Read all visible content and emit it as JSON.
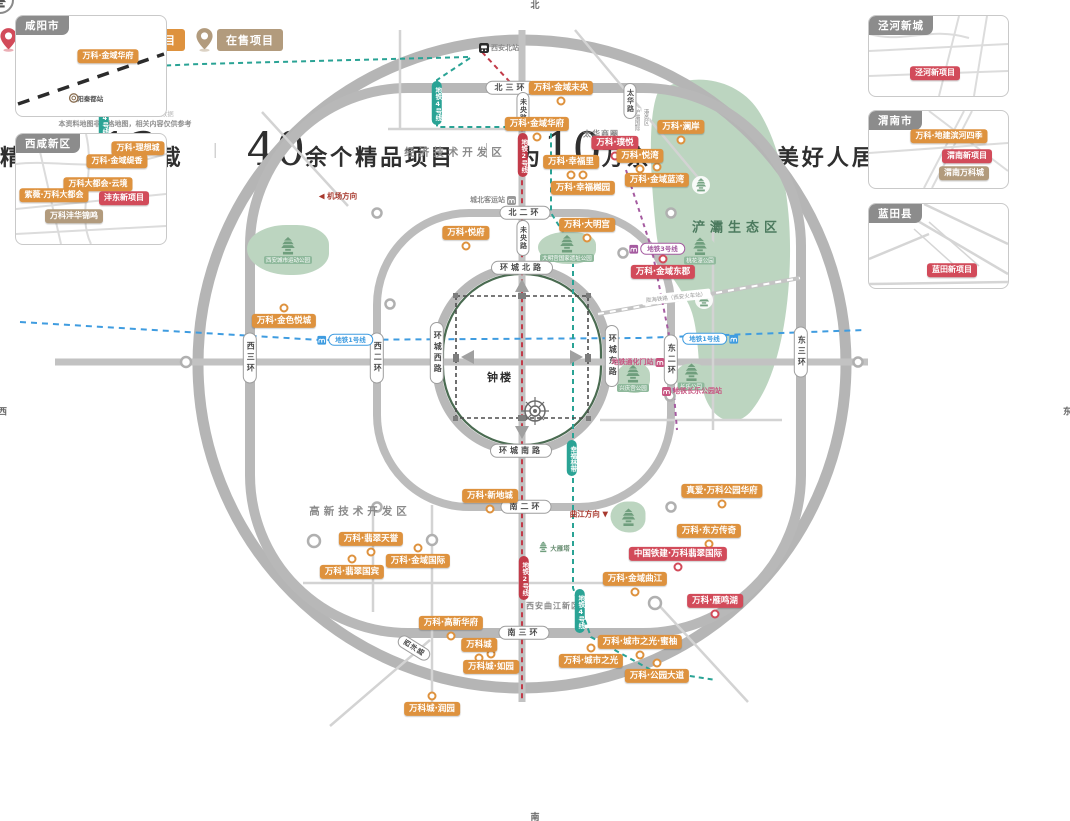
{
  "status_colors": {
    "presale": "#d24b5a",
    "soldout": "#de923e",
    "onsale": "#b29b7d"
  },
  "line_colors": {
    "1": "#3f9ce0",
    "2": "#c23b49",
    "3": "#a55ba0",
    "4": "#2aa395"
  },
  "legend": [
    {
      "label": "待售项目",
      "status": "presale"
    },
    {
      "label": "售罄项目",
      "status": "soldout"
    },
    {
      "label": "在售项目",
      "status": "onsale"
    }
  ],
  "footer": {
    "s1a": "精耕西安",
    "s1n": "13",
    "s1b": "载",
    "s2n": "40",
    "s2b": "余个精品项目",
    "s3a": "为",
    "s3n": "10",
    "s3b": "万余户业主打造美好人居生活",
    "divider": "｜"
  },
  "compass": {
    "n": "北",
    "s": "南",
    "e": "东",
    "w": "西"
  },
  "disclaimer": {
    "line1": "图中地铁信息来源于地铁官方数据",
    "line2": "本资料地图非严格地图，相关内容仅供参考"
  },
  "insets": [
    {
      "title": "咸阳市",
      "labels": [
        {
          "text": "万科·金域华府",
          "status": "soldout",
          "x": 92,
          "y": 40
        }
      ],
      "station": "咸阳秦都站",
      "station_x": 70,
      "station_y": 82
    },
    {
      "title": "西咸新区",
      "labels": [
        {
          "text": "万科·理想城",
          "status": "soldout",
          "x": 122,
          "y": 14
        },
        {
          "text": "万科·金域缇香",
          "status": "soldout",
          "x": 101,
          "y": 27
        },
        {
          "text": "万科大都会·云境",
          "status": "soldout",
          "x": 82,
          "y": 50
        },
        {
          "text": "紫薇·万科大都会",
          "status": "soldout",
          "x": 38,
          "y": 61
        },
        {
          "text": "沣东新项目",
          "status": "presale",
          "x": 108,
          "y": 64
        },
        {
          "text": "万科沣华锦鸣",
          "status": "onsale",
          "x": 58,
          "y": 82
        }
      ]
    },
    {
      "title": "泾河新城",
      "labels": [
        {
          "text": "泾河新项目",
          "status": "presale",
          "x": 66,
          "y": 57
        }
      ]
    },
    {
      "title": "渭南市",
      "labels": [
        {
          "text": "万科·地建滨河四季",
          "status": "soldout",
          "x": 80,
          "y": 25
        },
        {
          "text": "渭南新项目",
          "status": "presale",
          "x": 98,
          "y": 45
        },
        {
          "text": "渭南万科城",
          "status": "onsale",
          "x": 95,
          "y": 62
        }
      ]
    },
    {
      "title": "蓝田县",
      "labels": [
        {
          "text": "蓝田新项目",
          "status": "presale",
          "x": 83,
          "y": 66
        }
      ]
    }
  ],
  "map": {
    "projects": [
      {
        "text": "万科·金域未央",
        "status": "soldout",
        "x": 561,
        "y": 88,
        "pin": "below"
      },
      {
        "text": "万科·金域华府",
        "status": "soldout",
        "x": 537,
        "y": 124,
        "pin": "below"
      },
      {
        "text": "万科·璞悦",
        "status": "presale",
        "x": 615,
        "y": 143,
        "pin": "below"
      },
      {
        "text": "万科·悦湾",
        "status": "soldout",
        "x": 640,
        "y": 156,
        "pin": "below"
      },
      {
        "text": "万科·澜岸",
        "status": "soldout",
        "x": 681,
        "y": 127,
        "pin": "below"
      },
      {
        "text": "万科·幸福里",
        "status": "soldout",
        "x": 571,
        "y": 162,
        "pin": "below"
      },
      {
        "text": "万科·幸福樾园",
        "status": "soldout",
        "x": 583,
        "y": 188,
        "pin": "above"
      },
      {
        "text": "万科·金域蓝湾",
        "status": "soldout",
        "x": 657,
        "y": 180,
        "pin": "above"
      },
      {
        "text": "万科·大明宫",
        "status": "soldout",
        "x": 587,
        "y": 225,
        "pin": "below"
      },
      {
        "text": "万科·悦府",
        "status": "soldout",
        "x": 466,
        "y": 233,
        "pin": "below"
      },
      {
        "text": "万科·金域东郡",
        "status": "presale",
        "x": 663,
        "y": 272,
        "pin": "above"
      },
      {
        "text": "万科·金色悦城",
        "status": "soldout",
        "x": 284,
        "y": 321,
        "pin": "above"
      },
      {
        "text": "万科·新地城",
        "status": "soldout",
        "x": 490,
        "y": 496,
        "pin": "below"
      },
      {
        "text": "万科·翡翠天誉",
        "status": "soldout",
        "x": 371,
        "y": 539,
        "pin": "below"
      },
      {
        "text": "万科·金域国际",
        "status": "soldout",
        "x": 418,
        "y": 561,
        "pin": "above"
      },
      {
        "text": "万科·翡翠国宾",
        "status": "soldout",
        "x": 352,
        "y": 572,
        "pin": "above"
      },
      {
        "text": "万科·高新华府",
        "status": "soldout",
        "x": 451,
        "y": 623,
        "pin": "below"
      },
      {
        "text": "万科城",
        "status": "soldout",
        "x": 479,
        "y": 645,
        "pin": "below"
      },
      {
        "text": "万科城·如园",
        "status": "soldout",
        "x": 491,
        "y": 667,
        "pin": "above"
      },
      {
        "text": "万科城·润园",
        "status": "soldout",
        "x": 432,
        "y": 709,
        "pin": "above"
      },
      {
        "text": "万科·城市之光",
        "status": "soldout",
        "x": 591,
        "y": 661,
        "pin": "above"
      },
      {
        "text": "万科·城市之光·蜜柚",
        "status": "soldout",
        "x": 640,
        "y": 642,
        "pin": "below"
      },
      {
        "text": "万科·公园大道",
        "status": "soldout",
        "x": 657,
        "y": 676,
        "pin": "above"
      },
      {
        "text": "真爱·万科公园华府",
        "status": "soldout",
        "x": 722,
        "y": 491,
        "pin": "below"
      },
      {
        "text": "万科·东方传奇",
        "status": "soldout",
        "x": 709,
        "y": 531,
        "pin": "below"
      },
      {
        "text": "中国铁建·万科翡翠国际",
        "status": "presale",
        "x": 678,
        "y": 554,
        "pin": "below"
      },
      {
        "text": "万科·金域曲江",
        "status": "soldout",
        "x": 635,
        "y": 579,
        "pin": "below"
      },
      {
        "text": "万科·雁鸣湖",
        "status": "presale",
        "x": 715,
        "y": 601,
        "pin": "below"
      }
    ],
    "roads": [
      {
        "text": "北三环",
        "x": 511,
        "y": 88,
        "o": "h"
      },
      {
        "text": "北二环",
        "x": 525,
        "y": 213,
        "o": "h"
      },
      {
        "text": "环城北路",
        "x": 522,
        "y": 268,
        "o": "h"
      },
      {
        "text": "环城南路",
        "x": 521,
        "y": 451,
        "o": "h"
      },
      {
        "text": "南二环",
        "x": 526,
        "y": 507,
        "o": "h"
      },
      {
        "text": "南三环",
        "x": 524,
        "y": 633,
        "o": "h"
      },
      {
        "text": "西三环",
        "x": 250,
        "y": 358,
        "o": "v"
      },
      {
        "text": "西二环",
        "x": 377,
        "y": 358,
        "o": "v"
      },
      {
        "text": "环城西路",
        "x": 437,
        "y": 353,
        "o": "v"
      },
      {
        "text": "环城东路",
        "x": 612,
        "y": 356,
        "o": "v"
      },
      {
        "text": "东二环",
        "x": 671,
        "y": 360,
        "o": "v"
      },
      {
        "text": "东三环",
        "x": 801,
        "y": 352,
        "o": "v"
      },
      {
        "text": "未央路",
        "x": 523,
        "y": 110,
        "o": "v",
        "small": true
      },
      {
        "text": "未央路",
        "x": 523,
        "y": 238,
        "o": "v",
        "small": true
      },
      {
        "text": "太华路",
        "x": 630,
        "y": 101,
        "o": "v",
        "small": true
      },
      {
        "text": "西沣路",
        "x": 414,
        "y": 648,
        "o": "t",
        "small": true
      }
    ],
    "areas": [
      {
        "text": "经济技术开发区",
        "x": 455,
        "y": 152,
        "cls": ""
      },
      {
        "text": "太华商圈",
        "x": 601,
        "y": 134,
        "cls": "small"
      },
      {
        "text": "高新技术开发区",
        "x": 360,
        "y": 511,
        "cls": ""
      },
      {
        "text": "西安曲江新区",
        "x": 553,
        "y": 606,
        "cls": "small"
      },
      {
        "text": "浐灞生态区",
        "x": 737,
        "y": 226,
        "cls": "eco"
      }
    ],
    "directions": [
      {
        "text": "◀ 机场方向",
        "x": 338,
        "y": 196
      },
      {
        "text": "曲江方向 ▼",
        "x": 589,
        "y": 514
      }
    ],
    "port_cols": {
      "right": "港务区",
      "left": "沪灞国际",
      "x": 641,
      "y": 120
    },
    "rail_label": {
      "text": "陇海铁路（西安火车站）",
      "x": 676,
      "y": 297
    },
    "stations": [
      {
        "text": "西安北站",
        "x": 499,
        "y": 48,
        "icon": "rail",
        "side": "left"
      },
      {
        "text": "城北客运站",
        "x": 493,
        "y": 200,
        "icon": "metro",
        "color": "#9a9a9a",
        "side": "right"
      },
      {
        "text": "地铁通化门站",
        "x": 638,
        "y": 362,
        "icon": "metro",
        "color": "#c75480",
        "side": "right",
        "pink": true
      },
      {
        "text": "地铁长乐公园站",
        "x": 692,
        "y": 391,
        "icon": "metro",
        "color": "#c75480",
        "side": "left",
        "pink": true
      }
    ],
    "metro_pills": [
      {
        "text": "地铁1号线",
        "line": "1",
        "o": "h",
        "x": 345,
        "y": 340,
        "side": "left"
      },
      {
        "text": "地铁1号线",
        "line": "1",
        "o": "h",
        "x": 710,
        "y": 339,
        "side": "right"
      },
      {
        "text": "地铁2号线",
        "line": "2",
        "o": "v",
        "x": 523,
        "y": 155
      },
      {
        "text": "地铁2号线",
        "line": "2",
        "o": "v",
        "x": 524,
        "y": 578
      },
      {
        "text": "地铁3号线",
        "line": "3",
        "o": "h",
        "x": 657,
        "y": 249,
        "side": "left"
      },
      {
        "text": "地铁4号线",
        "line": "4",
        "o": "v",
        "x": 437,
        "y": 103
      },
      {
        "text": "幸福林带",
        "line": "4",
        "o": "v",
        "x": 572,
        "y": 458
      },
      {
        "text": "地铁4号线",
        "line": "4",
        "o": "v",
        "x": 580,
        "y": 611
      },
      {
        "text": "地铁14号线",
        "line": "4",
        "o": "v",
        "x": 104,
        "y": 113
      }
    ],
    "parks": [
      {
        "text": "西安城市运动公园",
        "x": 288,
        "y": 250,
        "w": 82,
        "h": 50
      },
      {
        "text": "大明宫国家遗址公园",
        "x": 567,
        "y": 248,
        "w": 58,
        "h": 32
      },
      {
        "text": "桃花潭公园",
        "x": 700,
        "y": 251,
        "w": 32,
        "h": 27
      },
      {
        "text": "兴庆宫公园",
        "x": 633,
        "y": 378,
        "w": 34,
        "h": 30
      },
      {
        "text": "长乐公园",
        "x": 691,
        "y": 377,
        "w": 31,
        "h": 27
      },
      {
        "text": "",
        "x": 628,
        "y": 517,
        "w": 35,
        "h": 31
      }
    ],
    "eco_pagodas": [
      {
        "x": 701,
        "y": 185
      },
      {
        "x": 704,
        "y": 300
      }
    ],
    "pois": [
      {
        "text": "大雁塔",
        "x": 554,
        "y": 547
      }
    ],
    "belltower": {
      "label": "钟楼",
      "icon_x": 524,
      "icon_y": 330,
      "label_x": 500,
      "label_y": 377
    }
  }
}
